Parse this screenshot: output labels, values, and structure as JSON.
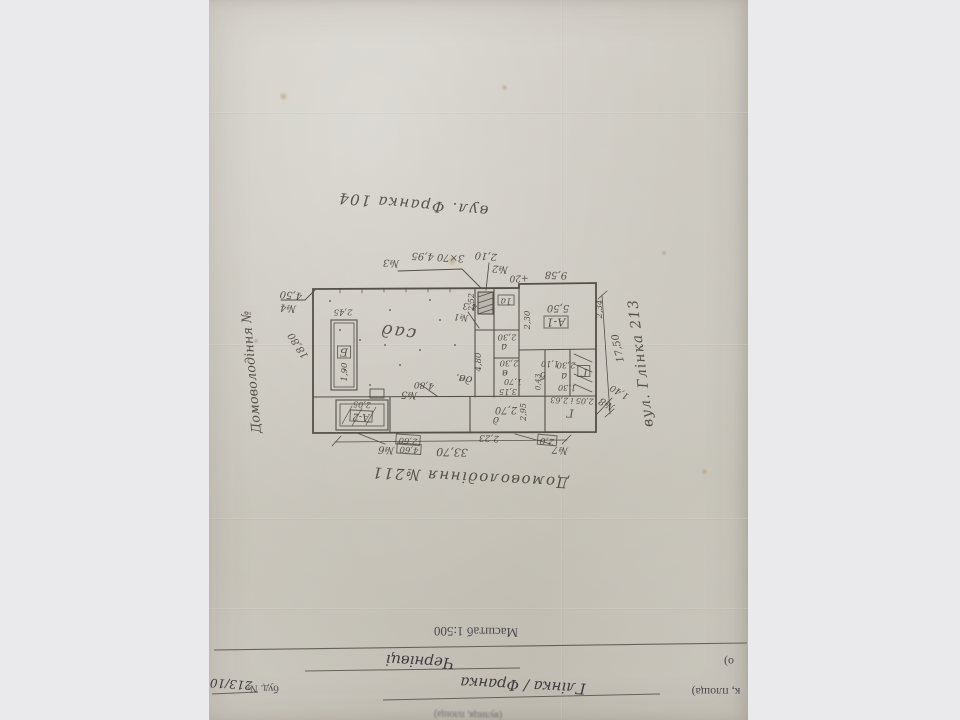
{
  "photo": {
    "background_color": "#eaeaec",
    "paper_color": "#cbc8bf",
    "orientation": "document appears rotated 180 degrees"
  },
  "plan": {
    "title_bottom": "Домоволодіння №211",
    "street_top": "вул. Франка 104",
    "street_right": "вул. Глінка 213",
    "owner_left": "Домоволодіння №",
    "garden_label": "сад",
    "overall_width": "33,70",
    "labels": [
      {
        "t": "вул. Франка 104",
        "x": 413,
        "y": 204,
        "r": 5,
        "s": 15,
        "w": 1.5,
        "n": "street-label-top"
      },
      {
        "t": "№3",
        "x": 391,
        "y": 262,
        "r": 3,
        "s": 10
      },
      {
        "t": "3×70  4,95",
        "x": 438,
        "y": 256,
        "r": 3,
        "s": 10
      },
      {
        "t": "№2",
        "x": 500,
        "y": 268,
        "r": 5,
        "s": 10
      },
      {
        "t": "2,10",
        "x": 486,
        "y": 255,
        "r": 5,
        "s": 10
      },
      {
        "t": "+20",
        "x": 519,
        "y": 277,
        "r": 0,
        "s": 9
      },
      {
        "t": "9,58",
        "x": 556,
        "y": 274,
        "r": 2,
        "s": 10
      },
      {
        "t": "№4",
        "x": 288,
        "y": 307,
        "r": 5,
        "s": 10
      },
      {
        "t": "4,50",
        "x": 291,
        "y": 294,
        "r": 5,
        "s": 10
      },
      {
        "t": "18,80",
        "x": 299,
        "y": 345,
        "r": 57,
        "s": 10
      },
      {
        "t": "Домоволодіння №",
        "x": 252,
        "y": 372,
        "r": 85,
        "s": 13,
        "n": "owner-label-left"
      },
      {
        "t": "сад",
        "x": 398,
        "y": 331,
        "r": 8,
        "s": 17,
        "w": 2,
        "n": "garden-label"
      },
      {
        "t": "№1",
        "x": 461,
        "y": 316,
        "r": 5,
        "s": 9
      },
      {
        "t": "4,3",
        "x": 470,
        "y": 305,
        "r": 5,
        "s": 9
      },
      {
        "t": "2,45",
        "x": 343,
        "y": 311,
        "r": 0,
        "s": 8.5
      },
      {
        "t": "Б",
        "x": 344,
        "y": 352,
        "r": 0,
        "s": 11,
        "b": 1
      },
      {
        "t": "1,90",
        "x": 345,
        "y": 372,
        "r": 90,
        "s": 8.5
      },
      {
        "t": "№5",
        "x": 409,
        "y": 394,
        "r": 4,
        "s": 10
      },
      {
        "t": "4,80",
        "x": 424,
        "y": 384,
        "r": 4,
        "s": 9
      },
      {
        "t": "4,80",
        "x": 479,
        "y": 362,
        "r": 90,
        "s": 8.5
      },
      {
        "t": "2,52",
        "x": 472,
        "y": 302,
        "r": 90,
        "s": 8
      },
      {
        "t": "дв.",
        "x": 464,
        "y": 379,
        "r": 10,
        "s": 11
      },
      {
        "t": "А-1",
        "x": 556,
        "y": 322,
        "r": 0,
        "s": 11,
        "b": 1
      },
      {
        "t": "5,50",
        "x": 558,
        "y": 307,
        "r": 0,
        "s": 10
      },
      {
        "t": "2,30",
        "x": 528,
        "y": 320,
        "r": 90,
        "s": 8.5
      },
      {
        "t": "2,34",
        "x": 600,
        "y": 309,
        "r": 90,
        "s": 8.5
      },
      {
        "t": "1а",
        "x": 506,
        "y": 300,
        "r": 0,
        "s": 9,
        "b": 1
      },
      {
        "t": "2,30",
        "x": 507,
        "y": 336,
        "r": 0,
        "s": 8.5
      },
      {
        "t": "а",
        "x": 504,
        "y": 346,
        "r": 0,
        "s": 10
      },
      {
        "t": "2,30",
        "x": 509,
        "y": 362,
        "r": 0,
        "s": 8.5
      },
      {
        "t": "в",
        "x": 505,
        "y": 372,
        "r": 0,
        "s": 10
      },
      {
        "t": "1,70",
        "x": 513,
        "y": 381,
        "r": 0,
        "s": 8
      },
      {
        "t": "3,15",
        "x": 508,
        "y": 391,
        "r": 0,
        "s": 8
      },
      {
        "t": "б",
        "x": 543,
        "y": 374,
        "r": 0,
        "s": 10
      },
      {
        "t": "1,10",
        "x": 550,
        "y": 363,
        "r": 0,
        "s": 8
      },
      {
        "t": "0,43",
        "x": 538,
        "y": 382,
        "r": 90,
        "s": 7.5
      },
      {
        "t": "2,30",
        "x": 566,
        "y": 364,
        "r": 0,
        "s": 8.5
      },
      {
        "t": "а",
        "x": 564,
        "y": 375,
        "r": 0,
        "s": 10
      },
      {
        "t": "1,30",
        "x": 567,
        "y": 387,
        "r": 0,
        "s": 8
      },
      {
        "t": "Г",
        "x": 584,
        "y": 371,
        "r": 0,
        "s": 10,
        "b": 1
      },
      {
        "t": "17,50",
        "x": 619,
        "y": 348,
        "r": 78,
        "s": 10
      },
      {
        "t": "вул. Глінка 213",
        "x": 641,
        "y": 363,
        "r": 83,
        "s": 14,
        "w": 1,
        "n": "street-label-right"
      },
      {
        "t": "№8",
        "x": 607,
        "y": 403,
        "r": 30,
        "s": 10
      },
      {
        "t": "1,40",
        "x": 620,
        "y": 391,
        "r": 30,
        "s": 9
      },
      {
        "t": "А-2",
        "x": 361,
        "y": 416,
        "r": 3,
        "s": 10,
        "b": 1
      },
      {
        "t": "2,05",
        "x": 362,
        "y": 404,
        "r": 3,
        "s": 8
      },
      {
        "t": "2,70",
        "x": 506,
        "y": 409,
        "r": 0,
        "s": 10
      },
      {
        "t": "д",
        "x": 496,
        "y": 419,
        "r": 0,
        "s": 10
      },
      {
        "t": "2,95",
        "x": 524,
        "y": 412,
        "r": 90,
        "s": 8
      },
      {
        "t": "2,23",
        "x": 489,
        "y": 437,
        "r": 2,
        "s": 9
      },
      {
        "t": "Г",
        "x": 570,
        "y": 413,
        "r": 0,
        "s": 11
      },
      {
        "t": "2,05 і 2,63",
        "x": 572,
        "y": 400,
        "r": 2,
        "s": 8
      },
      {
        "t": "№7",
        "x": 560,
        "y": 449,
        "r": 5,
        "s": 10
      },
      {
        "t": "2,0",
        "x": 547,
        "y": 440,
        "r": 5,
        "s": 9,
        "b": 1
      },
      {
        "t": "№6",
        "x": 386,
        "y": 449,
        "r": 4,
        "s": 10
      },
      {
        "t": "2,60",
        "x": 408,
        "y": 440,
        "r": 4,
        "s": 8.5,
        "b": 1
      },
      {
        "t": "4,60",
        "x": 409,
        "y": 449,
        "r": 4,
        "s": 8.5,
        "b": 1
      },
      {
        "t": "33,70",
        "x": 452,
        "y": 452,
        "r": 2,
        "s": 11
      },
      {
        "t": "Домоволодіння №211",
        "x": 470,
        "y": 477,
        "r": 3,
        "s": 15,
        "w": 1.5,
        "n": "plan-title"
      }
    ]
  },
  "letterhead": {
    "scale": "Масштаб 1:500",
    "street_line_fragment": "к, площа)",
    "street_value": "Глінка / Франка",
    "building_label": "буд. №",
    "building_number": "213/10",
    "city_line_fragment": "о)",
    "city_value": "Чернівці",
    "smallprint": "(вулиця, площа)",
    "labels": [
      {
        "t": "Масштаб 1:500",
        "x": 476,
        "y": 632,
        "r": 1,
        "s": 13,
        "c": "print",
        "n": "scale-label"
      },
      {
        "t": "Чернівці",
        "x": 420,
        "y": 661,
        "r": 3,
        "s": 15,
        "c": "ink",
        "n": "city-value"
      },
      {
        "t": "о)",
        "x": 729,
        "y": 662,
        "r": 0,
        "s": 12,
        "c": "print"
      },
      {
        "t": "к, площа)",
        "x": 716,
        "y": 692,
        "r": 0,
        "s": 12,
        "c": "print"
      },
      {
        "t": "Глінка / Франка",
        "x": 523,
        "y": 685,
        "r": 3,
        "s": 15,
        "c": "ink",
        "n": "street-value"
      },
      {
        "t": "буд. №",
        "x": 263,
        "y": 688,
        "r": 1,
        "s": 11,
        "c": "print"
      },
      {
        "t": "213/10",
        "x": 231,
        "y": 684,
        "r": 4,
        "s": 12,
        "c": "ink",
        "n": "building-number"
      },
      {
        "t": "(вулиця, площа)",
        "x": 468,
        "y": 714,
        "r": 1,
        "s": 10,
        "c": "print blur"
      }
    ]
  }
}
